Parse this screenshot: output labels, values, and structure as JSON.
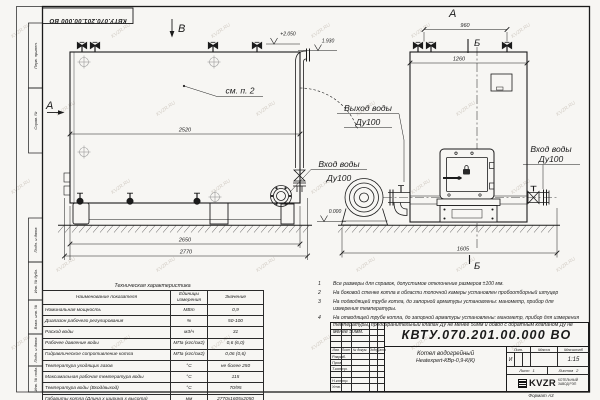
{
  "watermark": {
    "text": "KVZR.RU"
  },
  "frame": {
    "top_doc_number": "КВТУ.070.201.00.000 ВО",
    "stamps": [
      "Перв. примен.",
      "Справ. №",
      "Подп. и дата",
      "Инв. № дубл.",
      "Взам. инв. №",
      "Подп. и дата",
      "Инв. № подл."
    ],
    "format_note": "Формат А3"
  },
  "drawing": {
    "view_b_label": "В",
    "view_a_side_label": "А",
    "view_a_top_label": "А",
    "section_b_top": "Б",
    "section_b_bottom": "Б",
    "see_note_callout": "см. п. 2",
    "outlet_label_line1": "Выход воды",
    "outlet_label_line2": "Ду100",
    "inlet_side_label_line1": "Вход воды",
    "inlet_side_label_line2": "Ду100",
    "inlet_front_label_line1": "Вход воды",
    "inlet_front_label_line2": "Ду100",
    "elevation_top": "+2.050",
    "elevation_outlet": "1.930",
    "elevation_ground": "0.000",
    "dim_body_length": "2520",
    "dim_base_length": "2650",
    "dim_overall_length": "2770",
    "dim_top_nozzles": "960",
    "dim_body_width": "1260",
    "dim_overall_width": "1605"
  },
  "notes": {
    "items": [
      {
        "num": "1",
        "text": "Все размеры для справок, допустимое отклонение размеров ±100 мм."
      },
      {
        "num": "2",
        "text": "На боковой стенке котла в области топочной камеры установлен пробоотборный штуцер"
      },
      {
        "num": "3",
        "text": "На подводящей трубе котла, до запорной арматуры установлены: манометр, прибор для измерения температуры."
      },
      {
        "num": "4",
        "text": "На отводящей трубе котла, до запорной арматуры установлены: манометр, прибор для измерения температуры, предохранительный клапан Ду не менее 50мм и обвод с обратным клапаном Ду не менее 50мм."
      }
    ]
  },
  "tech_table": {
    "title": "Техническая характеристика",
    "col_headers": [
      "Наименование показателя",
      "Единицы измерения",
      "Значение"
    ],
    "rows": [
      {
        "name": "Номинальная мощность",
        "unit": "МВт",
        "value": "0,9"
      },
      {
        "name": "Диапазон рабочего регулирования",
        "unit": "%",
        "value": "50-100"
      },
      {
        "name": "Расход воды",
        "unit": "м3/ч",
        "value": "31"
      },
      {
        "name": "Рабочее давление воды",
        "unit": "МПа (кгс/см2)",
        "value": "0,6 (6,0)"
      },
      {
        "name": "Гидравлическое сопротивление котла",
        "unit": "МПа (кгс/см2)",
        "value": "0,06 (0,6)"
      },
      {
        "name": "Температура уходящих газов",
        "unit": "°С",
        "value": "не более 250"
      },
      {
        "name": "Максимальная рабочая температура воды",
        "unit": "°С",
        "value": "115"
      },
      {
        "name": "Температура воды (Вход/выход)",
        "unit": "°С",
        "value": "70/95"
      },
      {
        "name": "Габариты котла (Длина х ширина х высота)",
        "unit": "мм",
        "value": "2770х1605х2050"
      }
    ]
  },
  "title_block": {
    "doc_number": "КВТУ.070.201.00.000 ВО",
    "product_name": "Котел водогрейный",
    "product_model": "Heatexpert-КВр-0,9-К(К)",
    "col_izm": "Изм.",
    "col_list": "Лист",
    "col_doc": "№ докум.",
    "col_sign": "Подп.",
    "col_date": "Дата",
    "row_labels": [
      "Разраб.",
      "Пров.",
      "Т.контр.",
      "",
      "Н.контр.",
      "Утв."
    ],
    "lit_header": "Лит.",
    "mass_header": "Масса",
    "scale_header": "Масштаб",
    "lit_value": "И",
    "scale_value": "1:15",
    "sheet_label": "Лист",
    "sheet_value": "1",
    "sheets_label": "Листов",
    "sheets_value": "2",
    "logo_text": "KVZR",
    "company_line1": "КОТЕЛЬНЫЙ",
    "company_line2": "ЗАВОД РЭП"
  }
}
